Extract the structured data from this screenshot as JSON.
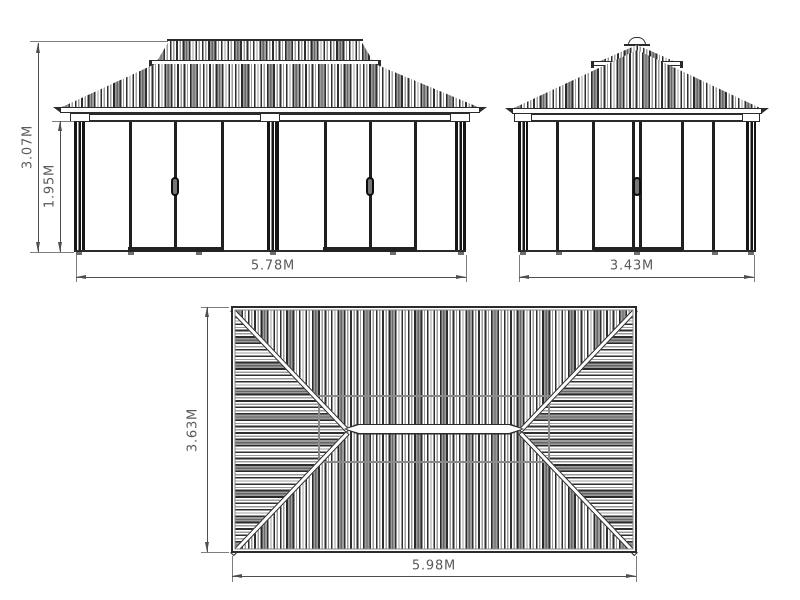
{
  "front_view": {
    "height_total": "3.07M",
    "height_wall": "1.95M",
    "width": "5.78M"
  },
  "side_view": {
    "width": "3.43M"
  },
  "top_view": {
    "depth": "3.63M",
    "width": "5.98M"
  },
  "style": {
    "line_color": "#2b2b2b",
    "dimension_color": "#4f4f4f",
    "label_color": "#595959",
    "background": "#ffffff"
  }
}
